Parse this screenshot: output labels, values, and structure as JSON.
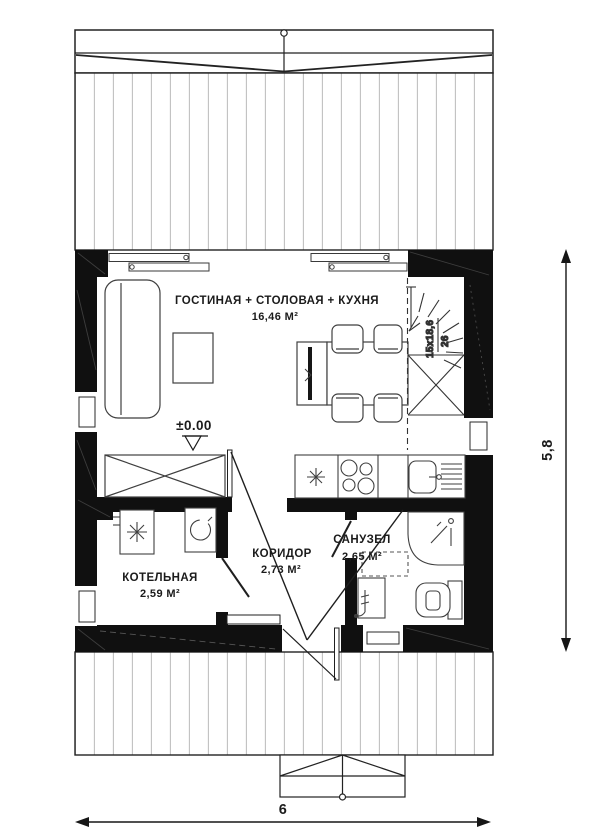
{
  "floor_plan": {
    "rooms": [
      {
        "id": "living_dining_kitchen",
        "label": "ГОСТИНАЯ + СТОЛОВАЯ + КУХНЯ",
        "area": "16,46 М²"
      },
      {
        "id": "corridor",
        "label": "КОРИДОР",
        "area": "2,73 М²"
      },
      {
        "id": "bathroom",
        "label": "САНУЗЕЛ",
        "area": "2,65 М²"
      },
      {
        "id": "boiler_room",
        "label": "КОТЕЛЬНАЯ",
        "area": "2,59 М²"
      }
    ],
    "annotations": {
      "floor_level": "±0.00",
      "stairs_step_note": "15x18,6",
      "stairs_width_note": "26"
    },
    "dimensions": {
      "overall_width_m": "6",
      "overall_depth_m": "5,8"
    },
    "symbols": [
      "roof-overhang",
      "terrace-deck",
      "sliding-window",
      "window",
      "sofa",
      "coffee-table",
      "tv-stand",
      "dining-table",
      "dining-chair",
      "wardrobe",
      "stairs",
      "kitchen-counter",
      "hob",
      "kitchen-sink",
      "boiler",
      "washing-machine",
      "shower",
      "washbasin",
      "toilet",
      "door-swing",
      "entrance-porch"
    ],
    "colors": {
      "walls": "#101010",
      "lines": "#1c1c1c",
      "planks": "#c3c3c3",
      "background": "#ffffff"
    }
  }
}
